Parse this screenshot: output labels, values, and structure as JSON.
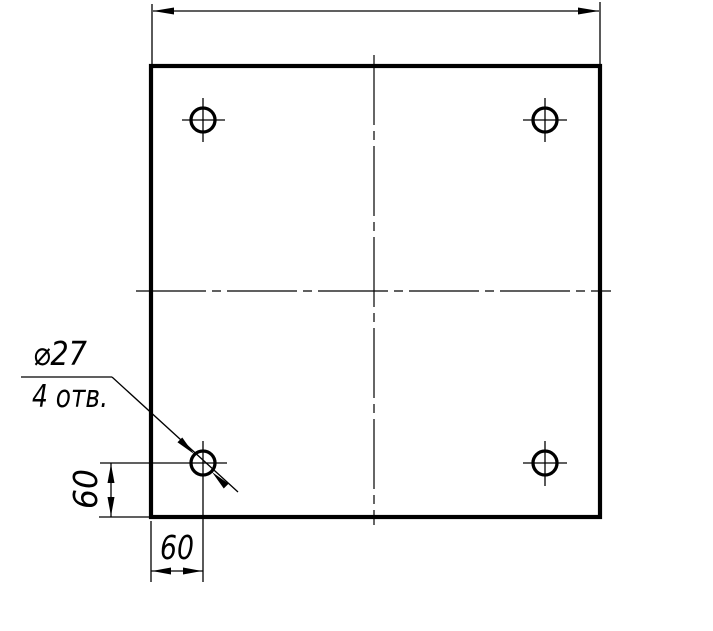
{
  "drawing": {
    "background_color": "#ffffff",
    "line_color": "#000000",
    "callout": {
      "diameter_label": "⌀27",
      "holes_count_label": "4 отв."
    },
    "dimensions": {
      "left_vertical_offset": "60",
      "bottom_horizontal_offset": "60"
    }
  }
}
